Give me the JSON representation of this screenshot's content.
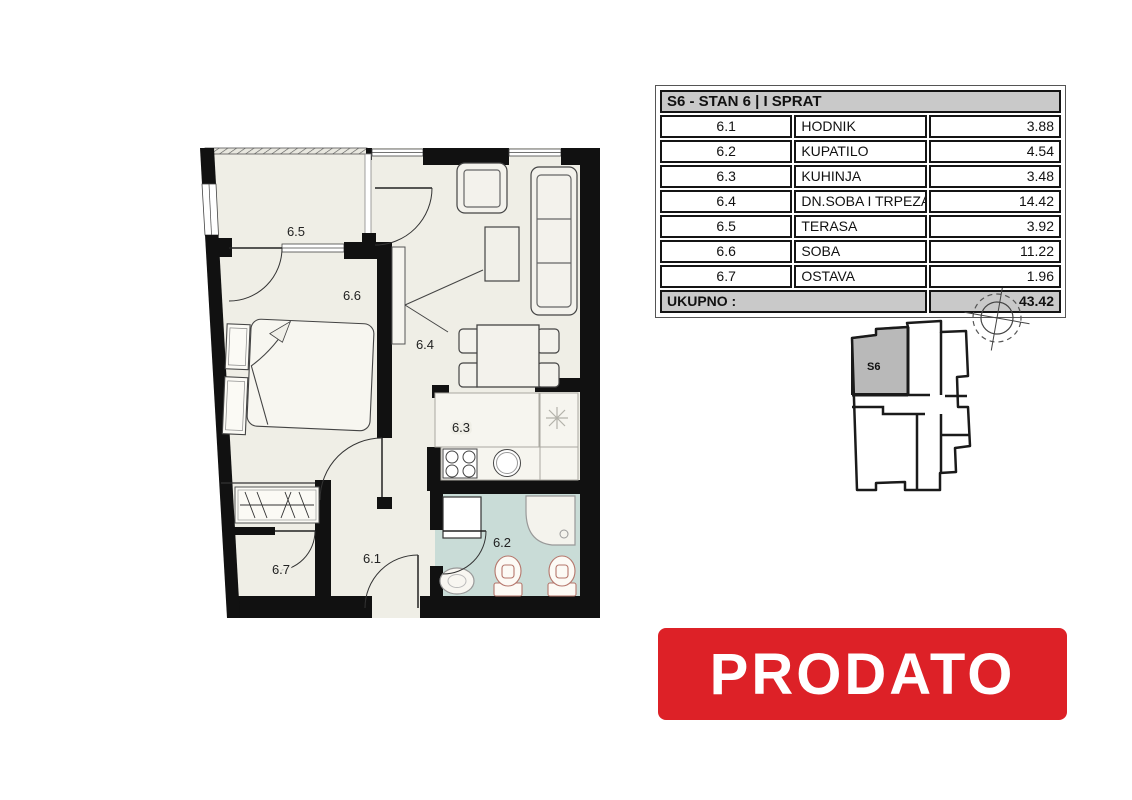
{
  "table": {
    "header": "S6 - STAN 6 | I SPRAT",
    "rows": [
      {
        "no": "6.1",
        "name": "HODNIK",
        "area": "3.88"
      },
      {
        "no": "6.2",
        "name": "KUPATILO",
        "area": "4.54"
      },
      {
        "no": "6.3",
        "name": "KUHINJA",
        "area": "3.48"
      },
      {
        "no": "6.4",
        "name": "DN.SOBA I TRPEZARIJA",
        "area": "14.42"
      },
      {
        "no": "6.5",
        "name": "TERASA",
        "area": "3.92"
      },
      {
        "no": "6.6",
        "name": "SOBA",
        "area": "11.22"
      },
      {
        "no": "6.7",
        "name": "OSTAVA",
        "area": "1.96"
      }
    ],
    "total_label": "UKUPNO :",
    "total_value": "43.42"
  },
  "floorplan": {
    "rooms": [
      {
        "id": "6.1"
      },
      {
        "id": "6.2"
      },
      {
        "id": "6.3"
      },
      {
        "id": "6.4"
      },
      {
        "id": "6.5"
      },
      {
        "id": "6.6"
      },
      {
        "id": "6.7"
      }
    ]
  },
  "keyplan": {
    "unit_label": "S6"
  },
  "banner": {
    "text": "PRODATO",
    "background": "#dd2127",
    "text_color": "#ffffff"
  },
  "colors": {
    "floor": "#efeee6",
    "bathroom_floor": "#c9dcd7",
    "wall": "#111111",
    "table_header_bg": "#c9c9c9",
    "keyplan_unit_fill": "#b9b9b9"
  }
}
